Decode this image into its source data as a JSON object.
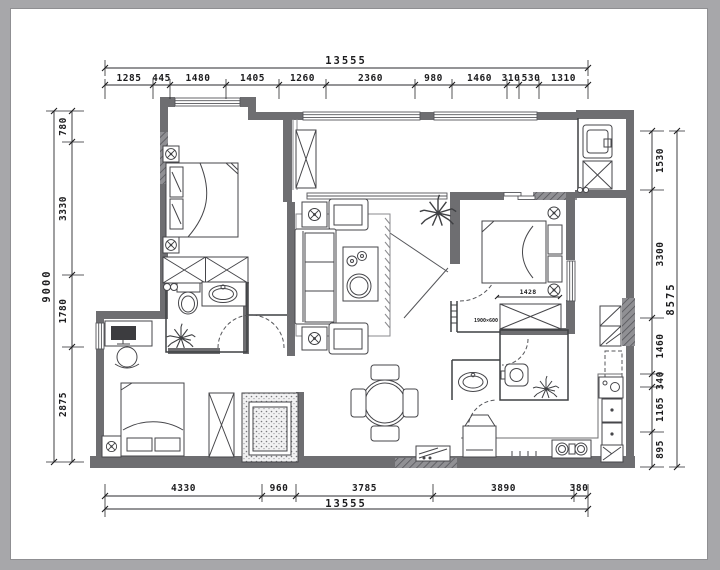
{
  "dimensions": {
    "top": {
      "total": "13555",
      "segments": [
        "1285",
        "445",
        "1480",
        "1405",
        "1260",
        "2360",
        "980",
        "1460",
        "310",
        "530",
        "1310"
      ]
    },
    "bottom": {
      "total": "13555",
      "segments": [
        "4330",
        "960",
        "3785",
        "3890",
        "380"
      ]
    },
    "left": {
      "total": "9000",
      "segments": [
        "780",
        "3330",
        "1780",
        "2875"
      ]
    },
    "right": {
      "total": "8575",
      "segments": [
        "1530",
        "3300",
        "1460",
        "340",
        "1165",
        "895"
      ]
    }
  },
  "plan_labels": {
    "bed_width": "1428",
    "wall_note": "1900×600"
  },
  "colors": {
    "page_background": "#a7a7aa",
    "paper": "#ffffff",
    "wall_fill": "#6e6e71",
    "line": "#3f4043",
    "dimension_text": "#1c1c1e"
  }
}
